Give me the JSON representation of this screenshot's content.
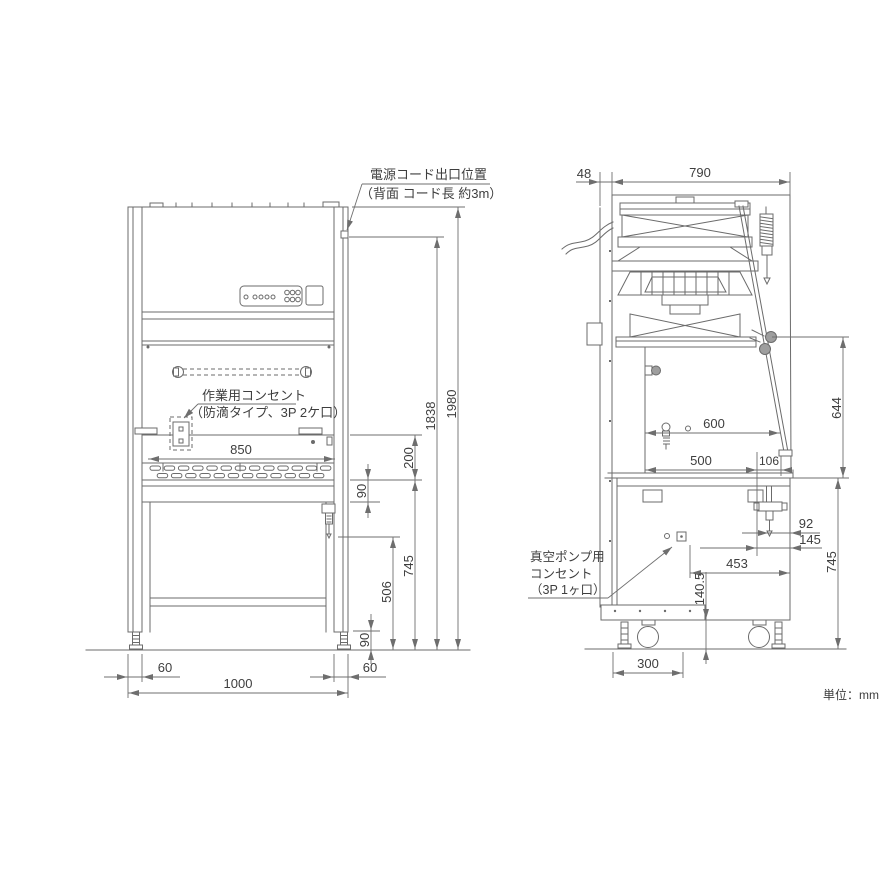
{
  "drawing": {
    "unit_note": "単位：mm",
    "labels": {
      "power_cord_1": "電源コード出口位置",
      "power_cord_2": "（背面 コード長 約3m）",
      "work_outlet_1": "作業用コンセント",
      "work_outlet_2": "（防滴タイプ、3P 2ケ口）",
      "vacuum_1": "真空ポンプ用",
      "vacuum_2": "コンセント",
      "vacuum_3": "（3P 1ヶ口）"
    },
    "front": {
      "dims": {
        "opening_width": "850",
        "sash_opening": "200",
        "apron": "90",
        "worktop_height": "745",
        "cock_height": "506",
        "foot": "90",
        "cord_exit_height": "1838",
        "overall_height": "1980",
        "left_post": "60",
        "overall_width": "1000",
        "right_post": "60"
      }
    },
    "side": {
      "dims": {
        "back_clearance": "48",
        "depth": "790",
        "inner_depth": "600",
        "worktop_depth": "500",
        "front_overhang": "106",
        "opening_height": "644",
        "drain_offset_a": "92",
        "drain_offset_b": "145",
        "outlet_depth": "453",
        "base_bottom_height": "140.5",
        "worktop_height": "745",
        "caster_offset": "300"
      }
    }
  },
  "colors": {
    "line": "#6b6b6b",
    "dim": "#6f6f6f",
    "text": "#3e3e3e",
    "accent_fill": "#9e9e9e",
    "bg": "#ffffff"
  }
}
